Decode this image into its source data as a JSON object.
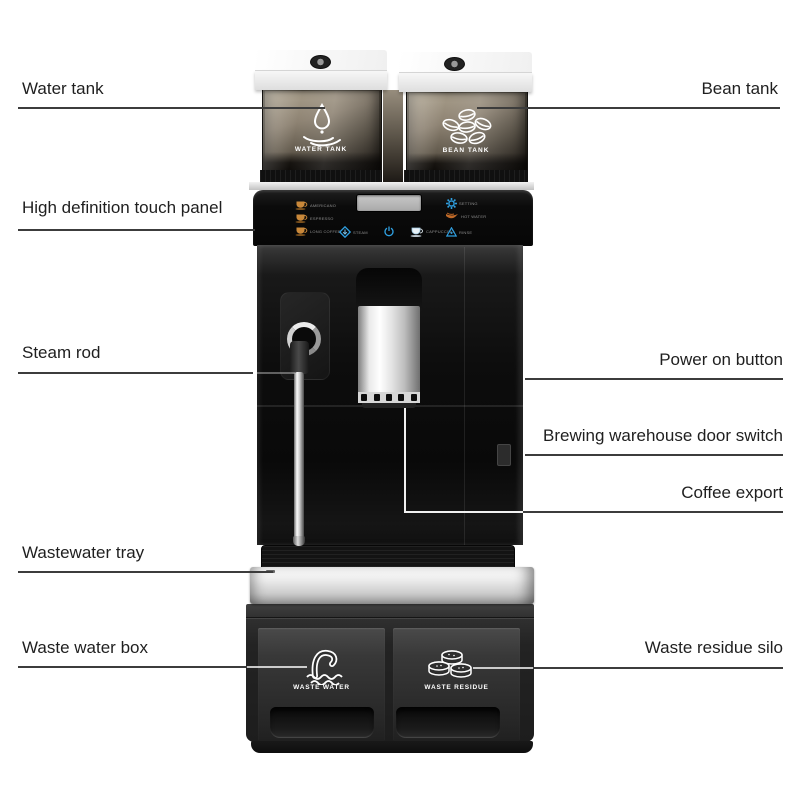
{
  "annotations": {
    "water_tank": "Water tank",
    "bean_tank": "Bean tank",
    "touch_panel": "High definition touch panel",
    "steam_rod": "Steam rod",
    "power_button": "Power on button",
    "brewing_switch": "Brewing warehouse door switch",
    "coffee_export": "Coffee export",
    "wastewater_tray": "Wastewater tray",
    "waste_water_box": "Waste water box",
    "waste_residue_silo": "Waste residue silo"
  },
  "machine": {
    "water_tank_text": "WATER TANK",
    "bean_tank_text": "BEAN TANK",
    "waste_water_text": "WASTE WATER",
    "waste_residue_text": "WASTE RESIDUE",
    "panel": {
      "drinks": [
        {
          "label": "AMERICANO",
          "icon": "coffee-cup-icon"
        },
        {
          "label": "ESPRESSO",
          "icon": "coffee-cup-icon"
        },
        {
          "label": "LONG COFFEE",
          "icon": "coffee-cup-icon"
        }
      ],
      "functions": [
        {
          "label": "STEAM",
          "icon": "steam-diamond-icon"
        },
        {
          "label": "CAPPUCCINO",
          "icon": "cappuccino-cup-icon"
        },
        {
          "label": "RINSE",
          "icon": "rinse-triangle-icon"
        }
      ],
      "settings": [
        {
          "label": "SETTING",
          "icon": "gear-icon"
        },
        {
          "label": "HOT WATER",
          "icon": "hot-water-icon"
        }
      ]
    }
  },
  "colors": {
    "accent_blue": "#2f9fe0",
    "cup_amber": "#c9883a",
    "leader_line": "#3c3c3c",
    "machine_black": "#0d0d0d",
    "silver_band": "#d9d9d9"
  }
}
